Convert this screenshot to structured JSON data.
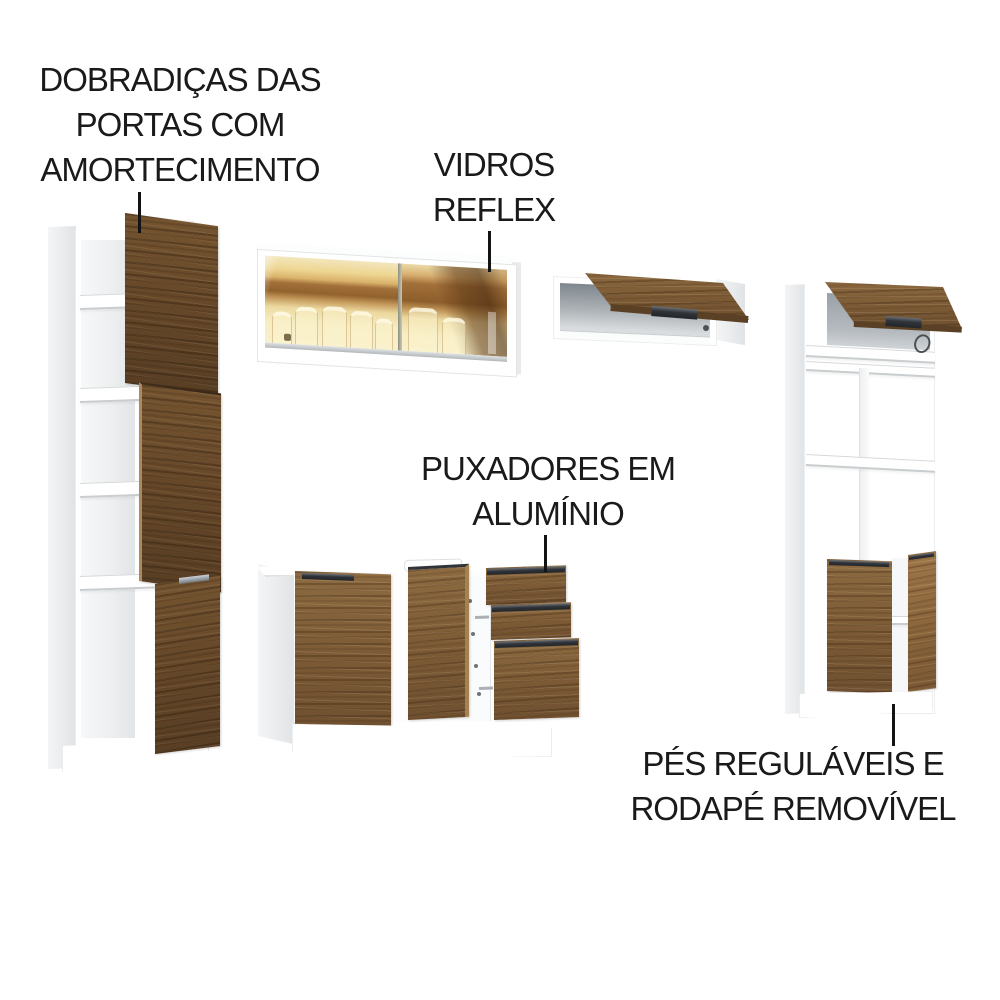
{
  "annotations": {
    "hinges": {
      "label": "DOBRADIÇAS DAS\nPORTAS COM\nAMORTECIMENTO"
    },
    "glass": {
      "label": "VIDROS\nREFLEX"
    },
    "handles": {
      "label": "PUXADORES EM\nALUMÍNIO"
    },
    "feet": {
      "label": "PÉS REGULÁVEIS E\nRODAPÉ REMOVÍVEL"
    }
  },
  "palette": {
    "background": "#ffffff",
    "text": "#1a1a1a",
    "pointer_line": "#131313",
    "cabinet_white": "#ffffff",
    "wood": "#7b5a35",
    "wood_dark": "#644628",
    "glass_gold": "#eed692",
    "glass_reflection_brown": "#92622d",
    "handle_dark": "#30343a",
    "handle_silver": "#8d959b"
  }
}
